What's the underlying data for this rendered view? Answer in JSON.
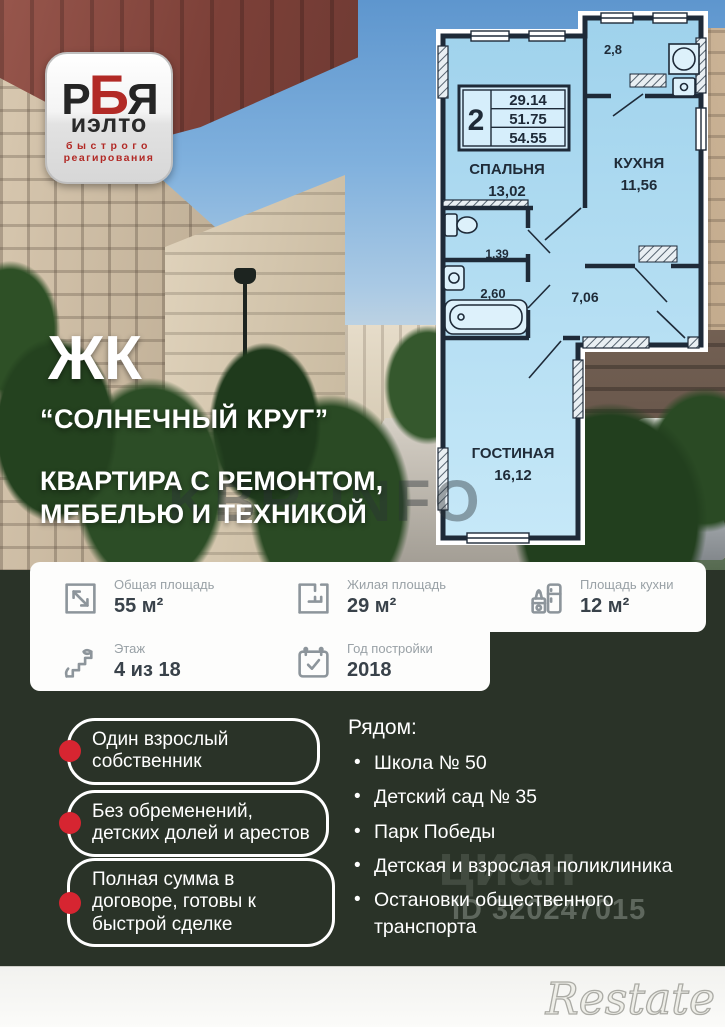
{
  "colors": {
    "accent_red": "#d62531",
    "dark_green_bg": "#2a3328",
    "plan_fill": "#a8d9f0",
    "card_bg": "#fdfdfc"
  },
  "logo": {
    "letter1": "Р",
    "letter2": "Б",
    "letter3": "Я",
    "word": "иэлто",
    "tagline1": "быстрого",
    "tagline2": "реагирования"
  },
  "headline": {
    "prefix": "ЖК",
    "name": "“СОЛНЕЧНЫЙ КРУГ”",
    "sub1": "КВАРТИРА С РЕМОНТОМ,",
    "sub2": "МЕБЕЛЬЮ И ТЕХНИКОЙ"
  },
  "floorplan": {
    "stamp": {
      "rooms_count": "2",
      "area_total": "29.14",
      "area_living": "51.75",
      "area_full": "54.55"
    },
    "rooms": {
      "bedroom": {
        "name": "СПАЛЬНЯ",
        "area": "13,02"
      },
      "kitchen": {
        "name": "КУХНЯ",
        "area": "11,56"
      },
      "balcony": {
        "area": "2,8"
      },
      "wc": {
        "area": "1,39"
      },
      "bath": {
        "area": "2,60"
      },
      "hall": {
        "area": "7,06"
      },
      "living": {
        "name": "ГОСТИНАЯ",
        "area": "16,12"
      }
    }
  },
  "stats": [
    {
      "label": "Общая площадь",
      "value": "55 м²",
      "icon": "area-arrow-icon"
    },
    {
      "label": "Жилая площадь",
      "value": "29 м²",
      "icon": "floorplan-icon"
    },
    {
      "label": "Площадь кухни",
      "value": "12 м²",
      "icon": "kitchen-icon"
    },
    {
      "label": "Этаж",
      "value": "4 из 18",
      "icon": "stairs-icon"
    },
    {
      "label": "Год постройки",
      "value": "2018",
      "icon": "calendar-check-icon"
    }
  ],
  "highlights": [
    "Один взрослый собственник",
    "Без обременений, детских долей и арестов",
    "Полная сумма в договоре, готовы к быстрой сделке"
  ],
  "nearby": {
    "title": "Рядом:",
    "items": [
      "Школа № 50",
      "Детский сад № 35",
      "Парк Победы",
      "Детская и взрослая поликлиника",
      "Остановки общественного транспорта"
    ]
  },
  "watermarks": {
    "center": "KBR-INFO",
    "cian": "циан",
    "cian_id": "ID 320247015",
    "restate": "Restate"
  }
}
